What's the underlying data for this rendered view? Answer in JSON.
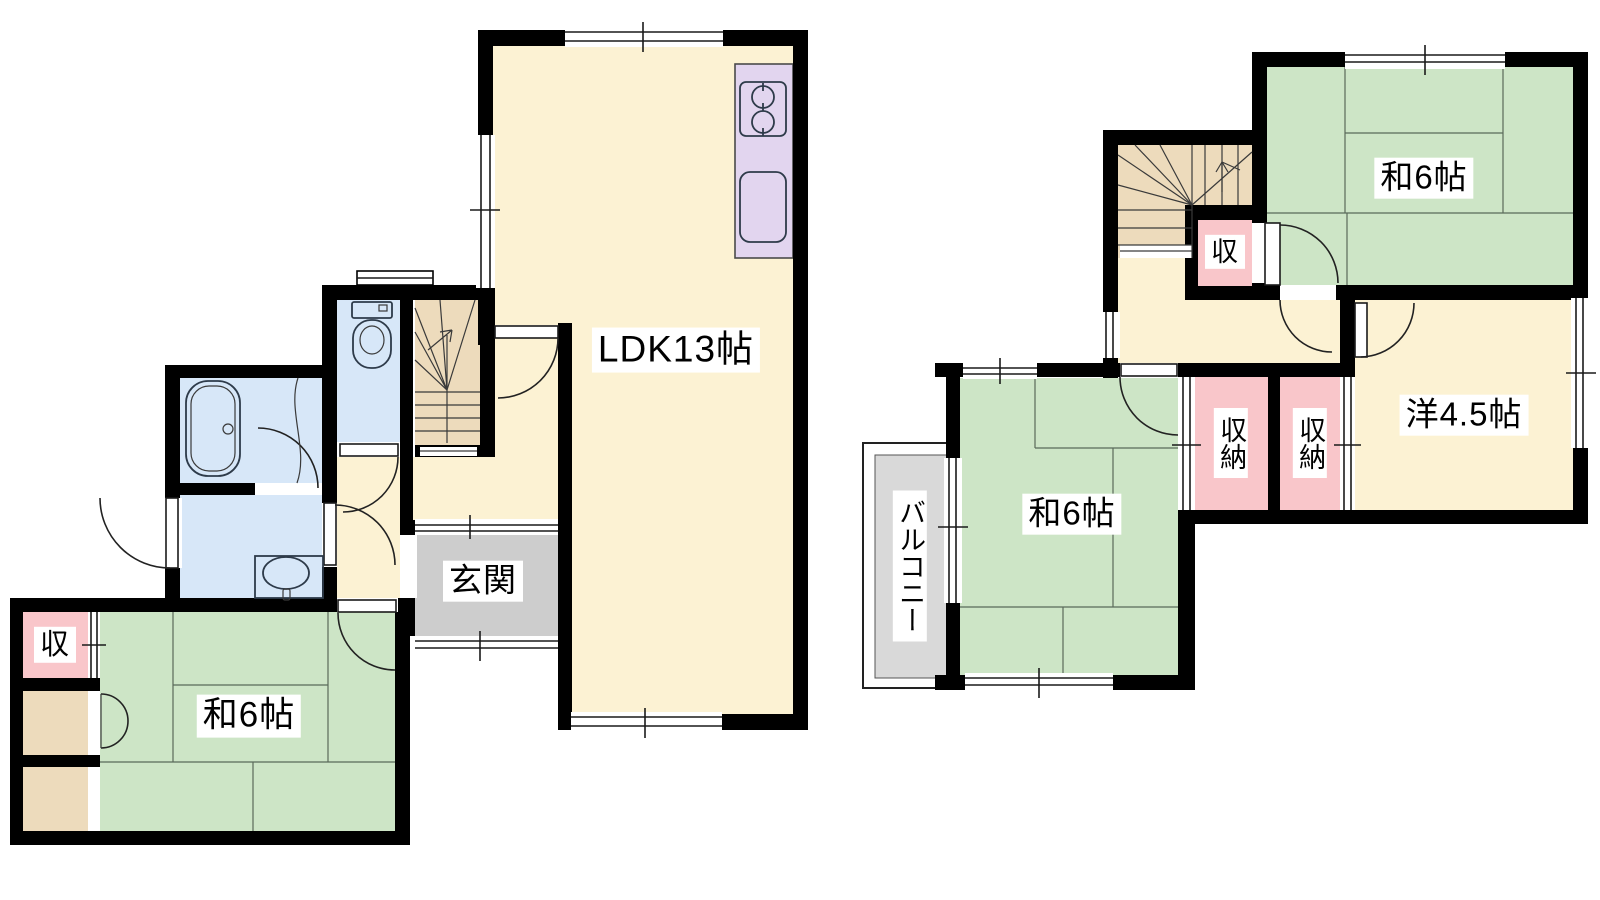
{
  "colors": {
    "cream": "#FCF2D3",
    "green": "#CDE5C6",
    "pink": "#F9C6CA",
    "tan": "#EDDBBC",
    "blue": "#D7E7F8",
    "lavender": "#E2D5EF",
    "gray": "#CDCDCD",
    "balcony_gray": "#D9D9D9",
    "wall": "#000000"
  },
  "floor1": {
    "rooms": {
      "ldk": {
        "label": "LDK13帖"
      },
      "genkan": {
        "label": "玄関"
      },
      "washitsu": {
        "label": "和6帖"
      },
      "closet": {
        "label": "収"
      }
    }
  },
  "floor2": {
    "rooms": {
      "washitsu_ne": {
        "label": "和6帖"
      },
      "washitsu_sw": {
        "label": "和6帖"
      },
      "youshitsu": {
        "label": "洋4.5帖"
      },
      "closet_left": {
        "label": "収納"
      },
      "closet_right": {
        "label": "収納"
      },
      "closet": {
        "label": "収"
      },
      "balcony": {
        "label": "バルコニー"
      }
    }
  }
}
